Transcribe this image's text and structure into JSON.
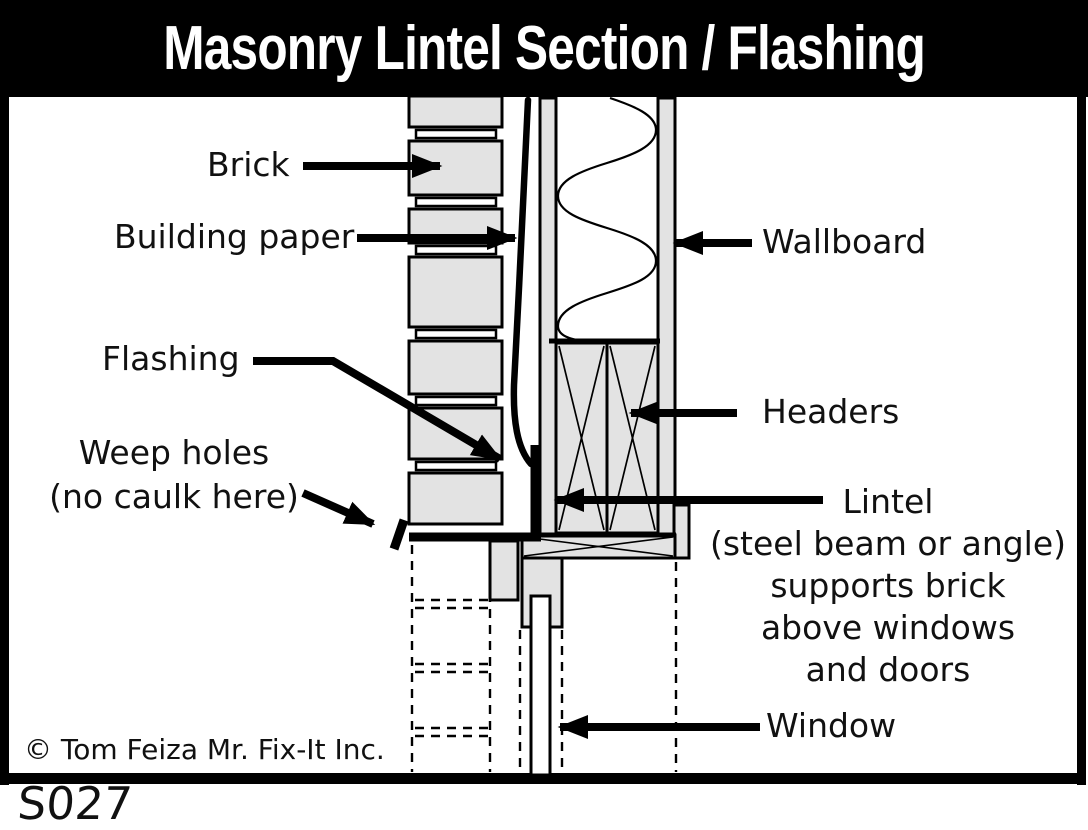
{
  "title": "Masonry Lintel Section / Flashing",
  "labels": {
    "brick": "Brick",
    "building_paper": "Building paper",
    "wallboard": "Wallboard",
    "flashing": "Flashing",
    "weep_lines": [
      "Weep holes",
      "(no caulk here)"
    ],
    "headers": "Headers",
    "lintel_lines": [
      "Lintel",
      "(steel beam or angle)",
      "supports brick",
      "above windows",
      "and doors"
    ],
    "window": "Window"
  },
  "footer": {
    "copyright": "© Tom Feiza Mr. Fix-It Inc.",
    "code": "S027"
  },
  "colors": {
    "background": "#ffffff",
    "line": "#000000",
    "material_fill": "#e3e3e3"
  }
}
